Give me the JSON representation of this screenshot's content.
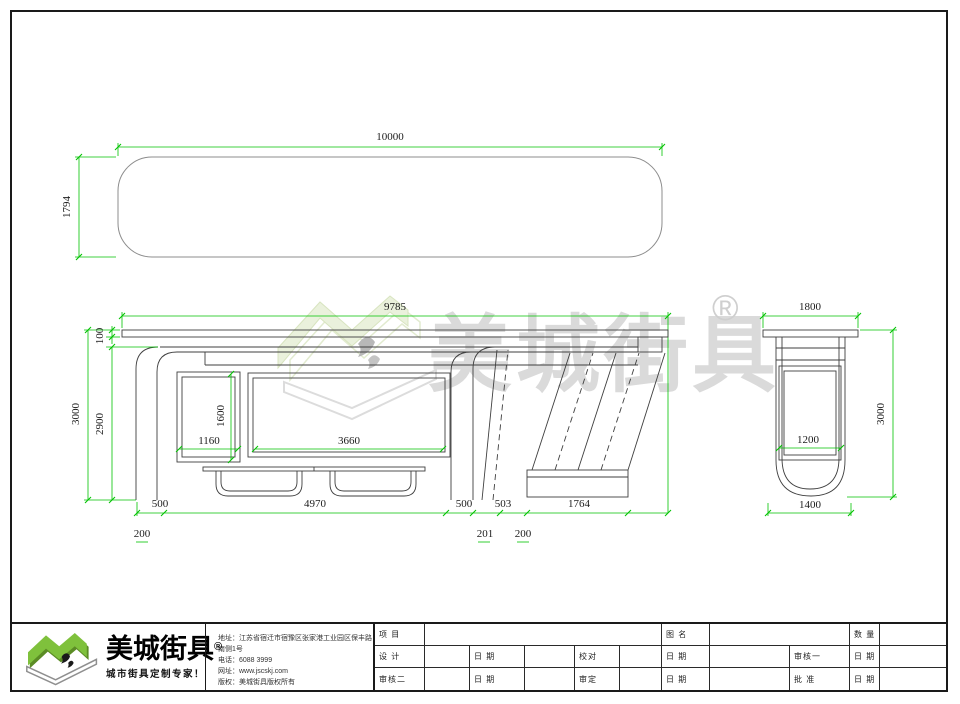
{
  "watermark": {
    "brand": "美城街具",
    "reg": "®"
  },
  "top_view": {
    "width": "10000",
    "depth": "1794"
  },
  "front_view": {
    "width": "9785",
    "roof_thickness": "100",
    "inner_height": "2900",
    "total_height": "3000",
    "left_panel_width": "1160",
    "left_panel_height": "1600",
    "ad_panel_width": "3660",
    "seg_a": "500",
    "seg_b": "4970",
    "seg_c": "500",
    "seg_d": "503",
    "seg_e": "1764",
    "off_a": "200",
    "off_b": "201",
    "off_c": "200"
  },
  "side_view": {
    "roof_width": "1800",
    "height": "3000",
    "panel_width": "1200",
    "base_width": "1400"
  },
  "footer": {
    "brand": "美城街具",
    "reg": "®",
    "tagline": "城市街具定制专家！",
    "address": "地址：江苏省宿迁市宿豫区张家港工业园区保丰路南侧1号",
    "phone": "电话：6088 3999",
    "website": "网址：www.jscskj.com",
    "copyright": "版权：美城街具版权所有",
    "table": {
      "project": "项 目",
      "name": "图 名",
      "qty": "数 量",
      "design": "设 计",
      "date": "日 期",
      "check": "校对",
      "review1": "审核一",
      "review2": "审核二",
      "verify": "审定",
      "approve": "批 准"
    }
  }
}
